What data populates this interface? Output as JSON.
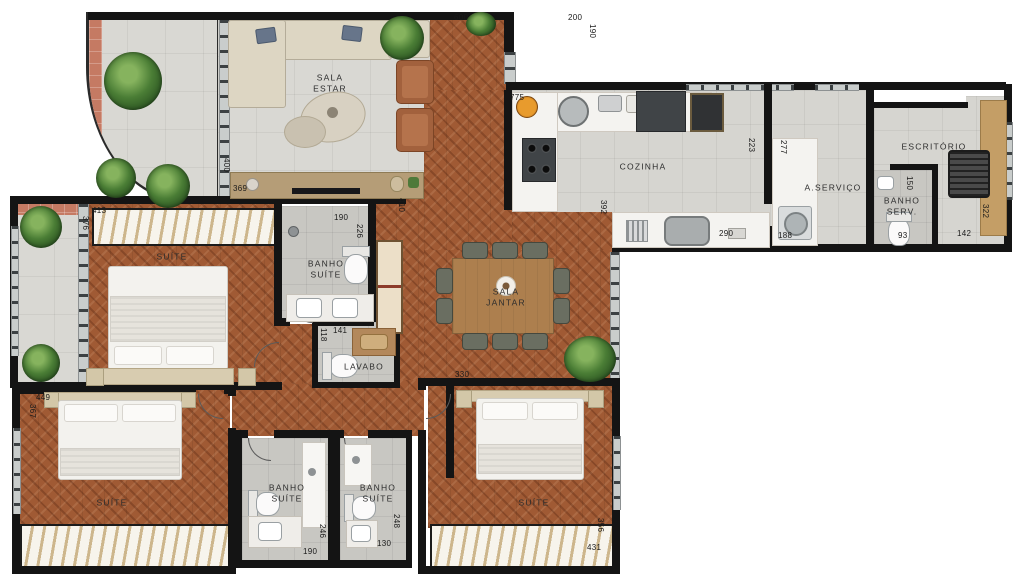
{
  "labels": {
    "sala_estar": [
      "SALA",
      "ESTAR"
    ],
    "cozinha": [
      "COZINHA"
    ],
    "escritorio": [
      "ESCRITÓRIO"
    ],
    "a_servico": [
      "A.SERVIÇO"
    ],
    "banho_serv": [
      "BANHO",
      "SERV."
    ],
    "sala_jantar": [
      "SALA",
      "JANTAR"
    ],
    "suite_1": [
      "SUÍTE"
    ],
    "banho_suite_1": [
      "BANHO",
      "SUÍTE"
    ],
    "lavabo": [
      "LAVABO"
    ],
    "suite_2": [
      "SUÍTE"
    ],
    "banho_suite_2": [
      "BANHO",
      "SUÍTE"
    ],
    "banho_suite_3": [
      "BANHO",
      "SUÍTE"
    ],
    "suite_3": [
      "SUÍTE"
    ]
  },
  "dimensions": [
    "600",
    "200",
    "190",
    "775",
    "223",
    "290",
    "392",
    "277",
    "188",
    "150",
    "93",
    "142",
    "322",
    "400",
    "369",
    "413",
    "376",
    "190",
    "226",
    "410",
    "118",
    "141",
    "330",
    "449",
    "367",
    "246",
    "190",
    "248",
    "130",
    "356",
    "431"
  ],
  "colors": {
    "wood_floor": "#a05a34",
    "tile_floor": "#d9d8d3",
    "wall": "#141414",
    "terrace_tile": "#c57a63",
    "hatch_stroke": "#cdb68c",
    "greenery": "#3f6b2e"
  }
}
